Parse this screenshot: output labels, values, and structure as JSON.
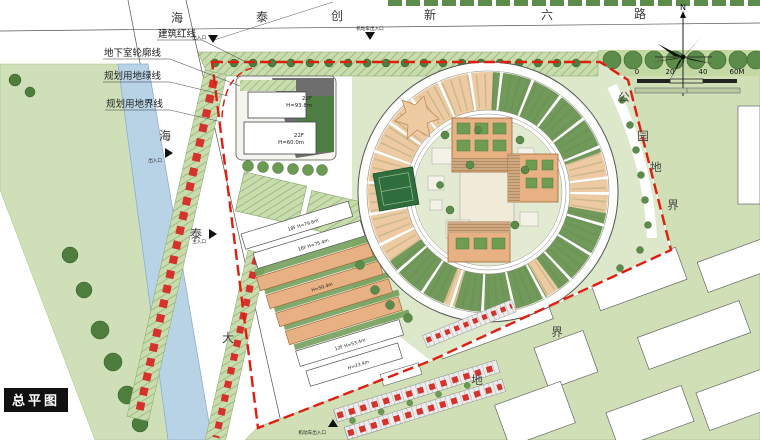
{
  "legend": {
    "title": "总平图"
  },
  "compass": {
    "north": "N"
  },
  "scalebar": {
    "ticks": [
      "0",
      "20",
      "40",
      "60M"
    ]
  },
  "roads": {
    "top": {
      "name": "海泰创新六路",
      "chars": [
        "海",
        "泰",
        "创",
        "新",
        "六",
        "路"
      ]
    },
    "left": {
      "name": "海泰大道",
      "chars": [
        "海",
        "泰",
        "大"
      ]
    }
  },
  "labels": {
    "boundary": [
      "建筑红线",
      "地下室轮廓线",
      "规划用地绿线",
      "规划用地界线"
    ],
    "park_chars": [
      "公",
      "园",
      "地",
      "界"
    ],
    "land_chars": [
      "界",
      "地"
    ]
  },
  "entrances": [
    "出入口",
    "机动车出入口",
    "出入口",
    "主入口",
    "机动车出入口"
  ],
  "buildings": {
    "tower_a": [
      "22F",
      "H=93.8m"
    ],
    "tower_b": [
      "22F",
      "H=60.0m"
    ],
    "slabs": [
      "18F H=79.6m",
      "16F H=75.4m",
      "H=50.4m",
      "12F H=53.4m",
      "H=23.4m"
    ]
  },
  "colors": {
    "red_line": "#e01e10",
    "water": "#b9d3e6",
    "park_green": "#d0dfb6",
    "lawn_green": "#dde8ca",
    "tree_green": "#4e7d3e",
    "ring_orange": "#eecaa2",
    "roof_green": "#71995a",
    "court_green": "#2f6e3c",
    "building_orange": "#e8b184"
  }
}
